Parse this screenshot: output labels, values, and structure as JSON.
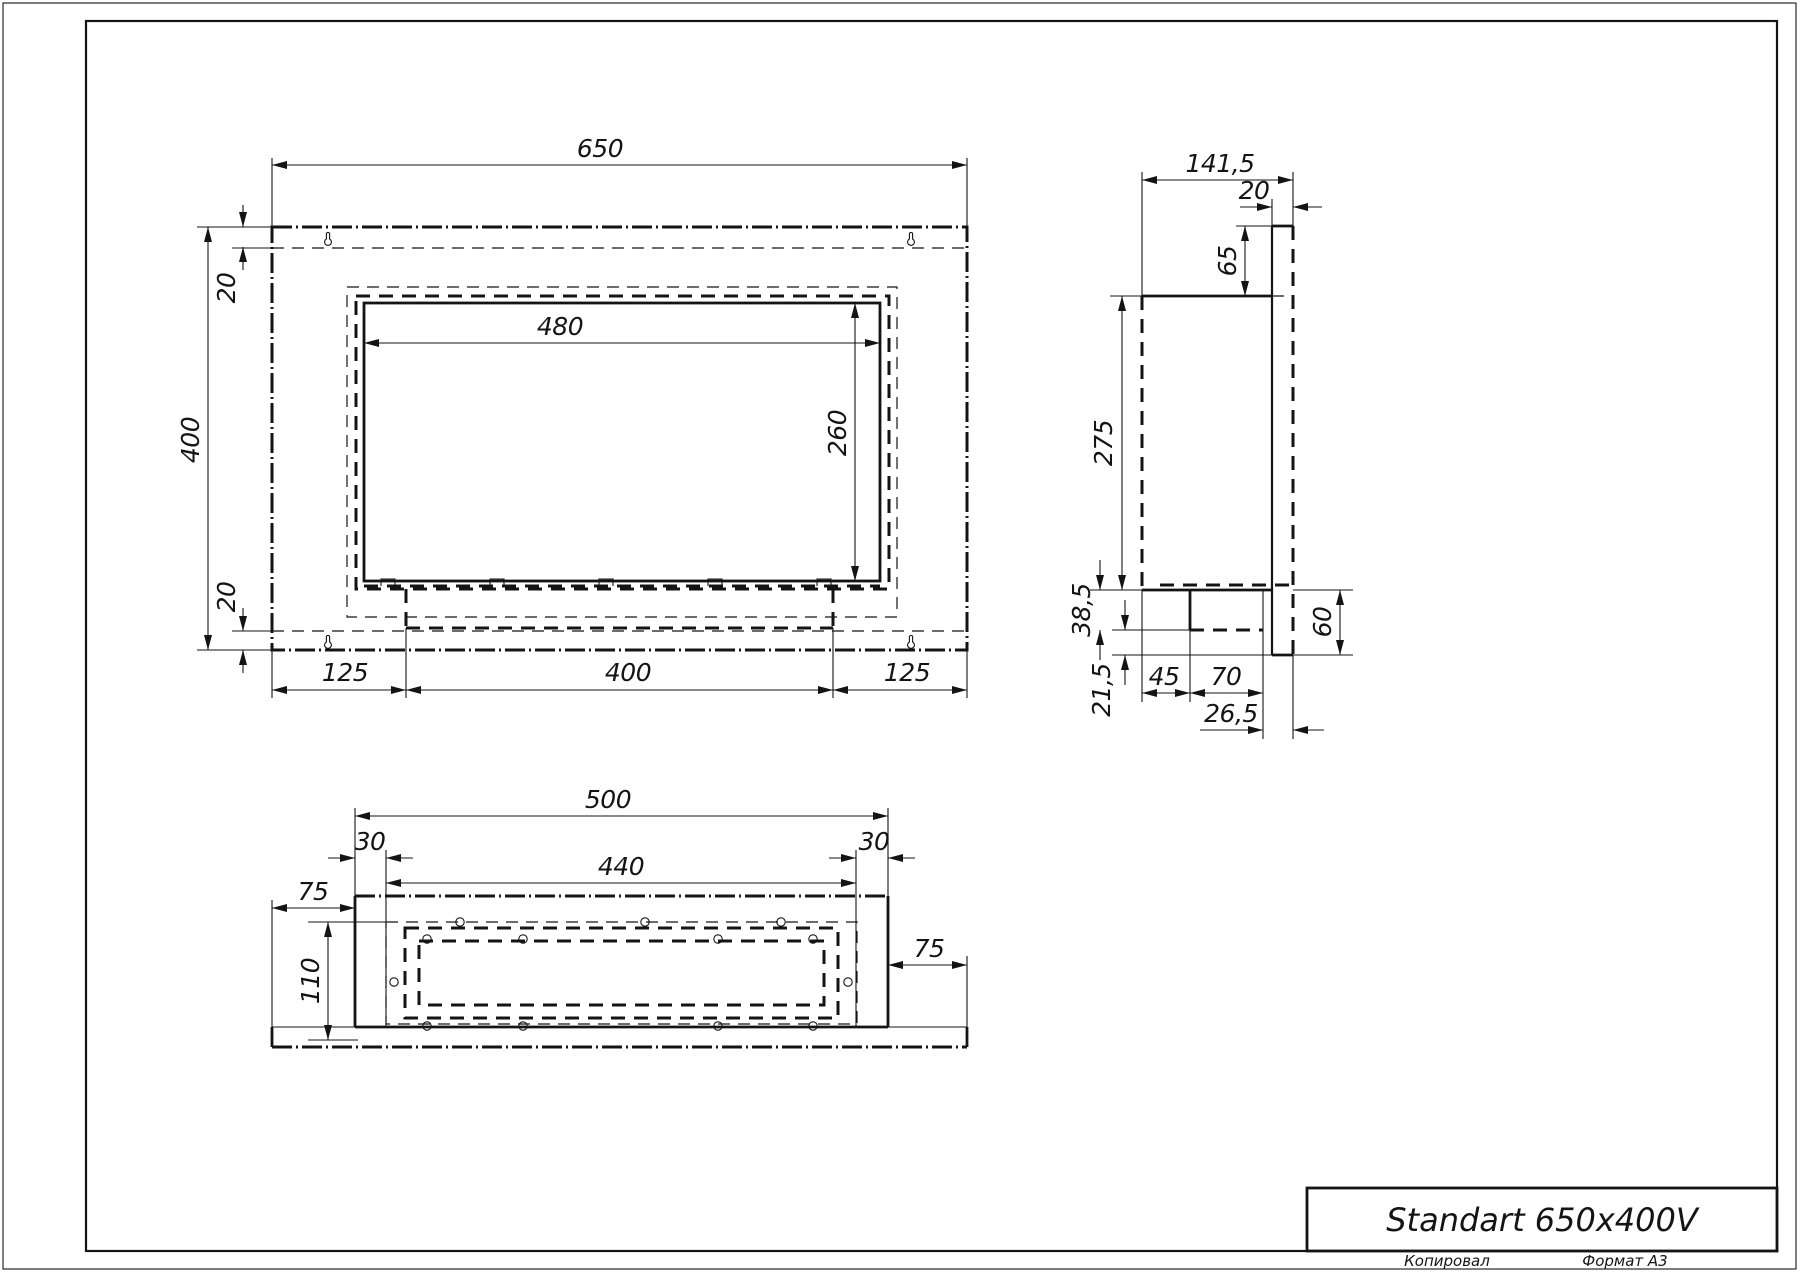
{
  "title_block": {
    "model": "Standart 650x400V",
    "copied_label": "Копировал",
    "format_label": "Формат А3"
  },
  "dims": {
    "front": {
      "overall_width": "650",
      "overall_height": "400",
      "top_offset": "20",
      "bottom_offset": "20",
      "opening_width": "480",
      "opening_height": "260",
      "bottom_left": "125",
      "bottom_center": "400",
      "bottom_right": "125"
    },
    "side": {
      "overall_depth": "141,5",
      "flange_thickness": "20",
      "flange_above": "65",
      "body_height": "275",
      "burner_height": "38,5",
      "below_burner": "21,5",
      "burner_inset": "45",
      "burner_depth": "70",
      "burner_offset": "26,5",
      "flange_below": "60"
    },
    "bottom": {
      "body_width": "500",
      "inset_left": "30",
      "chamber_width": "440",
      "inset_right": "30",
      "flange_left": "75",
      "flange_right": "75",
      "body_depth": "110"
    }
  }
}
